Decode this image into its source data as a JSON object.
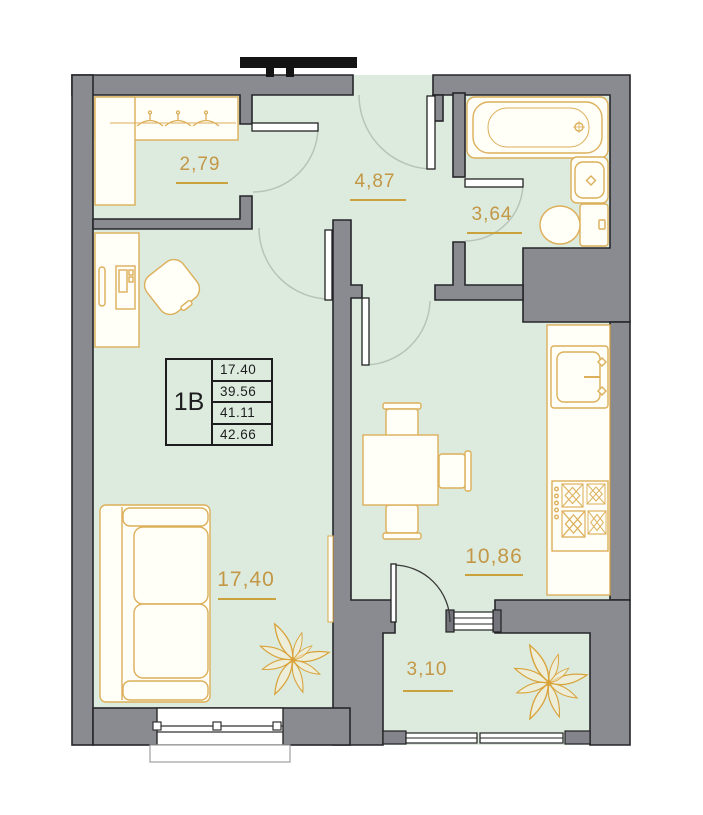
{
  "plan": {
    "unit": {
      "type_label": "1B",
      "areas": [
        "17.40",
        "39.56",
        "41.11",
        "42.66"
      ]
    },
    "rooms": [
      {
        "name": "wardrobe-room",
        "area": "2,79"
      },
      {
        "name": "hallway",
        "area": "4,87"
      },
      {
        "name": "bathroom",
        "area": "3,64"
      },
      {
        "name": "living-room",
        "area": "17,40"
      },
      {
        "name": "kitchen",
        "area": "10,86"
      },
      {
        "name": "balcony",
        "area": "3,10"
      }
    ],
    "colors": {
      "floor": "#dcebdd",
      "walls": "#8a8a91",
      "furniture_outline": "#dcaf5a",
      "label_text": "#c39746"
    }
  }
}
